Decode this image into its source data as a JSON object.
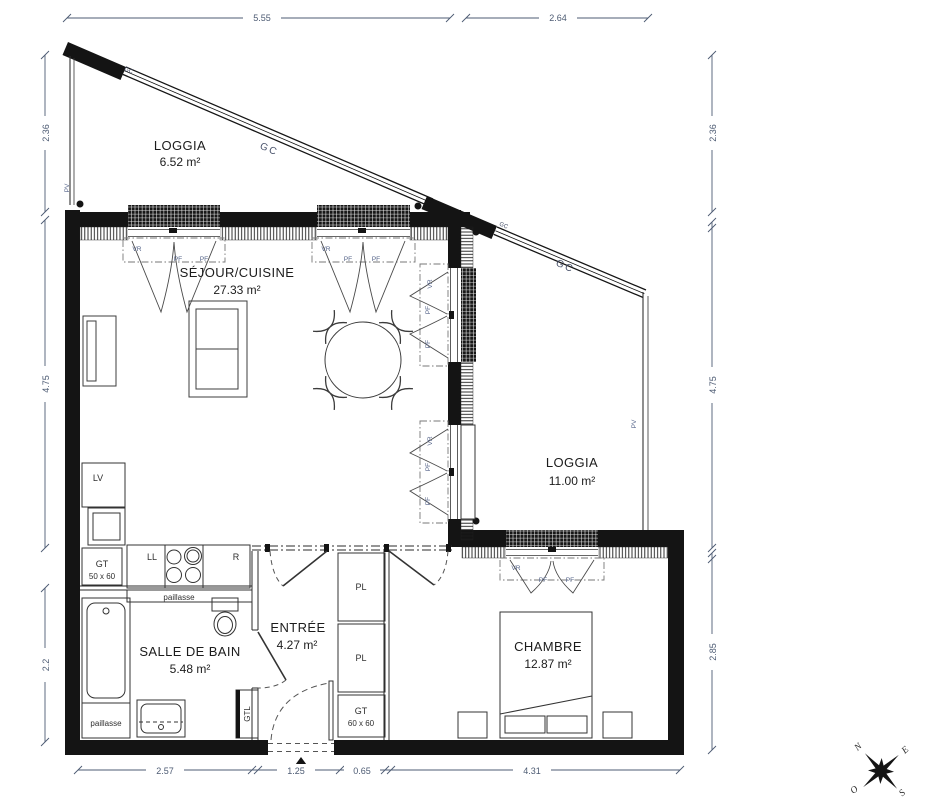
{
  "plan": {
    "rooms": {
      "loggia_top": {
        "name": "LOGGIA",
        "area": "6.52 m²"
      },
      "sejour_cuisine": {
        "name": "SÉJOUR/CUISINE",
        "area": "27.33 m²"
      },
      "loggia_right": {
        "name": "LOGGIA",
        "area": "11.00 m²"
      },
      "salle_de_bain": {
        "name": "SALLE DE BAIN",
        "area": "5.48 m²"
      },
      "entree": {
        "name": "ENTRÉE",
        "area": "4.27 m²"
      },
      "chambre": {
        "name": "CHAMBRE",
        "area": "12.87 m²"
      }
    },
    "fixtures": {
      "lv": "LV",
      "ll": "LL",
      "r": "R",
      "gt_kitchen": "GT",
      "gt_kitchen_size": "50 x 60",
      "gt_entree": "GT",
      "gt_entree_size": "60 x 60",
      "pl": "PL",
      "gtl": "GTL",
      "paillasse": "paillasse"
    },
    "glazing": {
      "vr": "VR",
      "pf": "PF",
      "gc": "GC",
      "pv": "PV"
    },
    "dimensions": {
      "top": [
        "5.55",
        "2.64"
      ],
      "left": [
        "2.36",
        "4.75",
        "2.2"
      ],
      "right": [
        "2.36",
        "4.75",
        "2.85"
      ],
      "bottom": [
        "2.57",
        "1.25",
        "0.65",
        "4.31"
      ]
    },
    "compass": {
      "n": "N",
      "e": "E",
      "s": "S",
      "o": "O"
    },
    "colors": {
      "wall": "#141414",
      "detail_line": "#3c3c3c",
      "glazing_label": "#56658a",
      "dimension_text": "#4d5b73"
    }
  }
}
